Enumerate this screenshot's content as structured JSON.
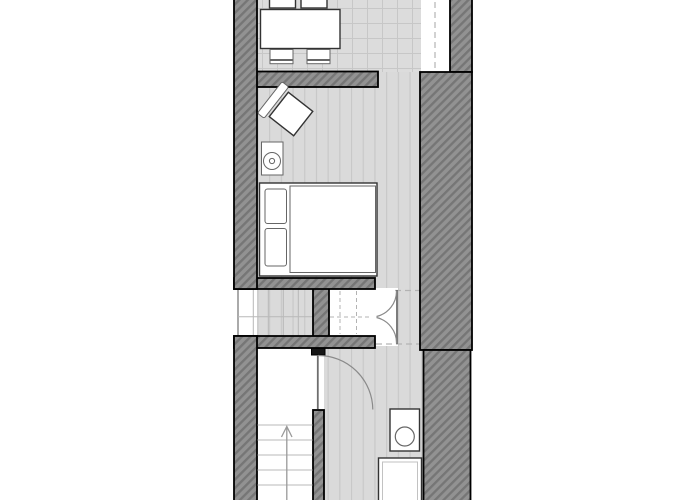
{
  "meta": {
    "title": "floor-plan",
    "kind": "architectural-floor-plan",
    "visible_text": []
  },
  "colors": {
    "background": "#ffffff",
    "wall_base": "#929292",
    "wall_line": "#767676",
    "wall_outline": "#000000",
    "floor_base": "#dadada",
    "floor_line": "#c7c7c7",
    "tile_base": "#dcdcdc",
    "tread_line": "#b8b8b8",
    "dashed_line": "#b3b3b3",
    "door_line": "#8a8a8a",
    "furniture_fill": "#ffffff",
    "furniture_outline": "#333333"
  },
  "rooms": [
    {
      "name": "dining-area",
      "floor": "tile-grid",
      "position": "top",
      "contents": [
        "dining-table",
        "chairs-x4"
      ]
    },
    {
      "name": "bedroom",
      "floor": "wood-plank",
      "position": "upper-middle",
      "contents": [
        "double-bed",
        "armchair",
        "stove"
      ]
    },
    {
      "name": "staircase-upper",
      "floor": "stair-treads",
      "position": "middle-left"
    },
    {
      "name": "closet",
      "floor": "dashed-treads-above",
      "position": "middle-center",
      "door": "double-swing-right"
    },
    {
      "name": "hallway",
      "floor": "wood-plank",
      "position": "middle-right",
      "overhead_dashed_lines": 2
    },
    {
      "name": "stair-landing",
      "floor": "plain",
      "position": "bottom-left",
      "door": "single-into-bathroom"
    },
    {
      "name": "bathroom",
      "floor": "wood-plank",
      "position": "bottom-right",
      "contents": [
        "washbasin",
        "shower-tray"
      ]
    },
    {
      "name": "staircase-lower",
      "floor": "stair-treads",
      "position": "bottom-left",
      "direction_arrow": "up"
    }
  ],
  "openings": [
    {
      "name": "right-wall-opening",
      "position": "top-right",
      "marker": "vertical-dashed-line"
    },
    {
      "name": "dining-bedroom-passage",
      "position": "right-of-dining-wall"
    }
  ],
  "furniture": [
    {
      "name": "dining-table",
      "shape": "rectangle"
    },
    {
      "name": "chair",
      "count": 4
    },
    {
      "name": "armchair",
      "rotation_deg": 38
    },
    {
      "name": "stove",
      "shape": "rect-with-circle"
    },
    {
      "name": "double-bed",
      "pillows": 2
    },
    {
      "name": "washbasin",
      "shape": "rect-with-circle"
    },
    {
      "name": "shower-tray",
      "shape": "double-rect"
    }
  ],
  "doors": [
    {
      "name": "closet-double-door",
      "type": "double",
      "swing": "into-hallway"
    },
    {
      "name": "bathroom-door",
      "type": "single",
      "swing": "into-bathroom"
    }
  ],
  "stairs": {
    "upper_flight": "treads-grid",
    "lower_flight_arrow": "up"
  }
}
